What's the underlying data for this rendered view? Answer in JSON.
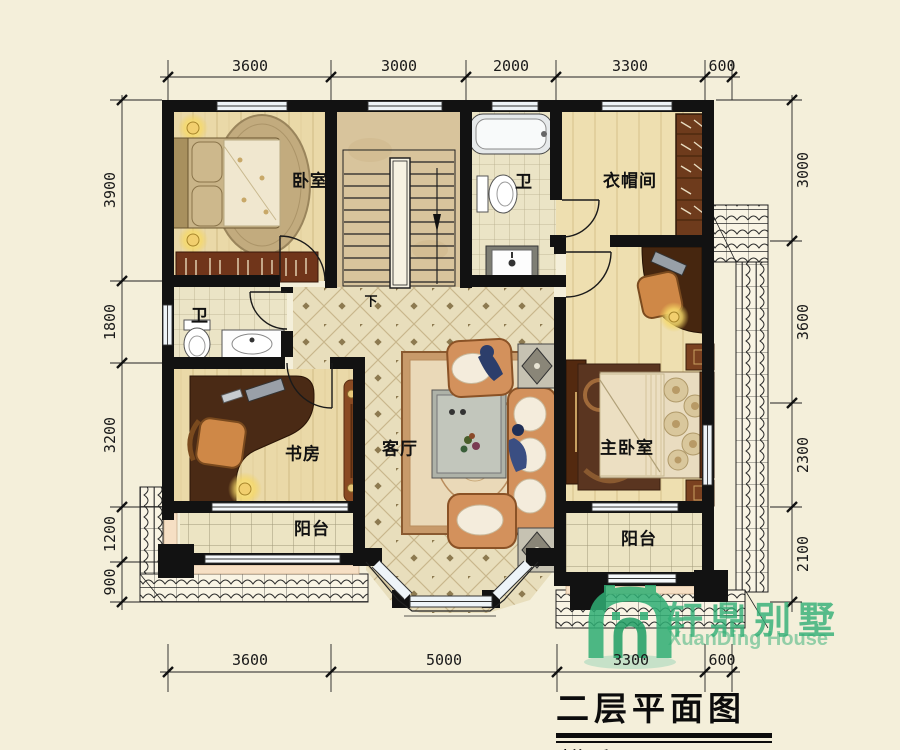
{
  "title": {
    "main": "二层平面图",
    "area": "建筑面积122.34m²"
  },
  "logo": {
    "cn": "轩鼎别墅",
    "en": "XuanDing House",
    "green": "#2fae74"
  },
  "labels": {
    "bedroom": "卧室",
    "bath_top": "卫",
    "cloakroom": "衣帽间",
    "bath_mid": "卫",
    "study": "书房",
    "living": "客厅",
    "master": "主卧室",
    "balcony_left": "阳台",
    "balcony_right": "阳台",
    "stairs_down": "下"
  },
  "dimensions": {
    "top": [
      "3600",
      "3000",
      "2000",
      "3300",
      "600"
    ],
    "bottom": [
      "3600",
      "5000",
      "3300",
      "600"
    ],
    "left": [
      "3900",
      "1800",
      "3200",
      "1200",
      "900"
    ],
    "right": [
      "3000",
      "3600",
      "2300",
      "2100"
    ]
  },
  "colors": {
    "wall": "#121212",
    "background": "#f4efda",
    "logo_green": "#2fae74"
  }
}
